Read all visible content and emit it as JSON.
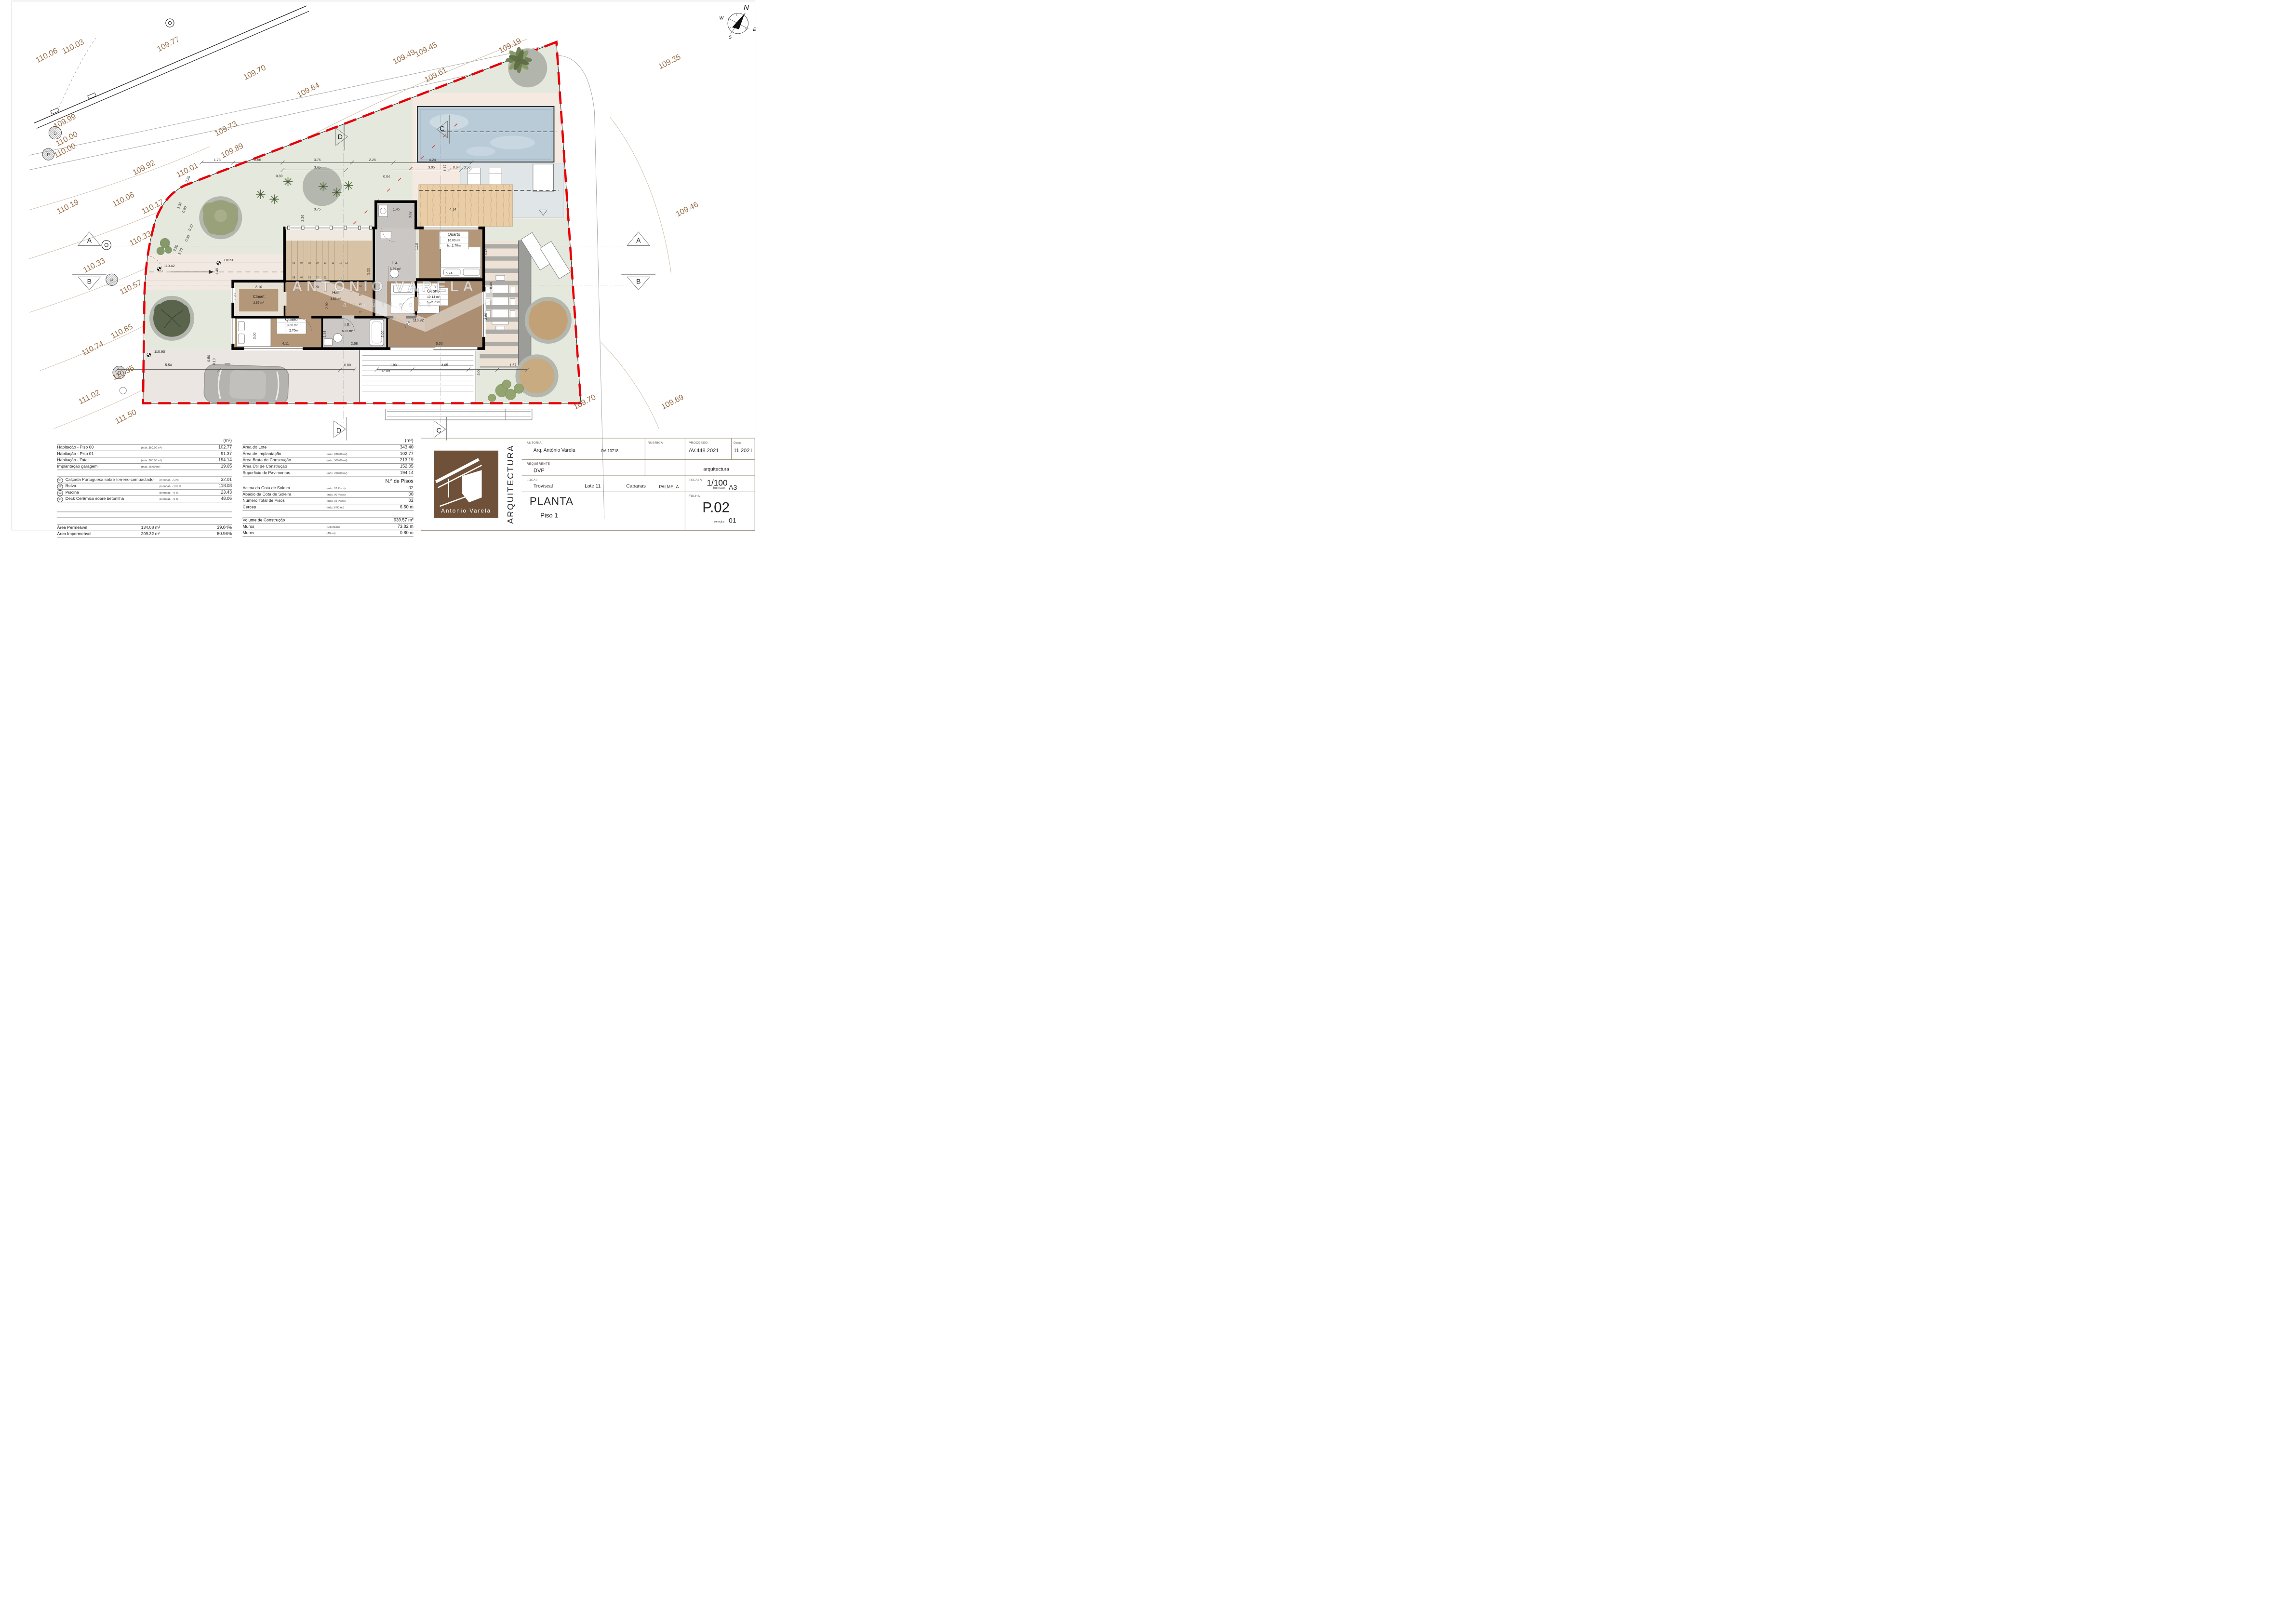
{
  "colors": {
    "boundary_red": "#e60008",
    "contour_text": "#8f6137",
    "logo_brown": "#6e5138",
    "lawn_green": "#e4e8dd",
    "pool_blue": "#b9cbd7",
    "floor_brown": "#b49778",
    "wall_black": "#000000"
  },
  "titleblock": {
    "autoria_label": "AUTORIA",
    "autoria": "Arq. António Varela",
    "oa": "OA.13718",
    "rubrica_label": "RUBRICA",
    "processo_label": "PROCESSO",
    "processo": "AV.448.2021",
    "data_label": "Data",
    "data": "11.2021",
    "requerente_label": "REQUERENTE",
    "requerente": "DVP",
    "discipline": "arquitectura",
    "local_label": "LOCAL",
    "local1": "Troviscal",
    "local2": "Lote 11",
    "local3": "Cabanas",
    "local4": "PALMELA",
    "escala_label": "ESCALA",
    "escala": "1/100",
    "formato_label": "formato",
    "formato": "A3",
    "folha_label": "FOLHA",
    "folha": "P.02",
    "versao_label": "versão",
    "versao": "01",
    "vertical": "ARQUITECTURA",
    "title": "PLANTA",
    "subtitle": "Piso 1",
    "logo_name": "Antonio  Varela"
  },
  "tables": {
    "left": {
      "header_unit": "(m²)",
      "rows": [
        {
          "label": "Habitação - Piso 00",
          "note": "(máx. 280.00 m²)",
          "value": "102.77"
        },
        {
          "label": "Habitação - Piso 01",
          "note": "",
          "value": "91.37"
        },
        {
          "label": "Habitação - Total",
          "note": "(máx. 280.00 m²)",
          "value": "194.14"
        },
        {
          "label": "Implantação garagem",
          "note": "(máx.  25.00 m²)",
          "value": "19.05"
        }
      ],
      "items": [
        {
          "num": "01",
          "label": "Calçada Portuguesa sobre terreno compactado",
          "note": "permeab. -  50%",
          "value": "32.01"
        },
        {
          "num": "02",
          "label": "Relva",
          "note": "permeab. - 100 %",
          "value": "118.08"
        },
        {
          "num": "03",
          "label": "Piscina",
          "note": "permeab. -  0 %",
          "value": "23.43"
        },
        {
          "num": "04",
          "label": "Deck Cerâmico sobre betonilha",
          "note": "permeab. -  0 %",
          "value": "48.06"
        }
      ],
      "totals": [
        {
          "label": "Área Permeável",
          "mid": "134.08 m²",
          "value": "39.04%"
        },
        {
          "label": "Área Impermeável",
          "mid": "209.32 m²",
          "value": "60.96%"
        }
      ]
    },
    "middle": {
      "header_unit": "(m²)",
      "rows": [
        {
          "label": "Área do Lote",
          "note": "",
          "value": "343.40"
        },
        {
          "label": "Área de Implantação",
          "note": "(máx. 280.00 m²)",
          "value": "102.77"
        },
        {
          "label": "Área Bruta de Construção",
          "note": "(máx. 305.00 m²)",
          "value": "213.19"
        },
        {
          "label": "Área Útil de Construção",
          "note": "",
          "value": "152.05"
        },
        {
          "label": "Superficie de Pavimentos",
          "note": "(máx. 280.00 m²)",
          "value": "194.14"
        }
      ],
      "pisos_header": "N.º  de Pisos",
      "pisos": [
        {
          "label": "Acima da Cota de Soleira",
          "note": "(máx. 02 Pisos)",
          "value": "02"
        },
        {
          "label": "Abaixo da Cota de Soleira",
          "note": "(máx. 00 Pisos)",
          "value": "00"
        },
        {
          "label": "Número Total de Pisos",
          "note": "(máx. 02 Pisos)",
          "value": "02"
        },
        {
          "label": "Cércea",
          "note": "(máx.   6.50  m )",
          "value": "6.50 m"
        }
      ],
      "extras": [
        {
          "label": "Volume de Construção",
          "note": "",
          "value": "639.57 m³"
        },
        {
          "label": "Muros",
          "note": "(Extensão)",
          "value": "73.82 m"
        },
        {
          "label": "Muros",
          "note": "(Altura)",
          "value": "0.80 m"
        }
      ]
    }
  },
  "plan": {
    "groups": [
      {
        "name": "contour-elevations",
        "cls": "ct",
        "rot": -27,
        "items": [
          [
            "110.03",
            152,
            100
          ],
          [
            "110.06",
            98,
            118
          ],
          [
            "109.77",
            347,
            95
          ],
          [
            "109.70",
            524,
            153
          ],
          [
            "109.64",
            634,
            189
          ],
          [
            "109.73",
            465,
            268
          ],
          [
            "109.89",
            478,
            313
          ],
          [
            "109.99",
            135,
            253
          ],
          [
            "110.00",
            139,
            289
          ],
          [
            "110.00",
            135,
            313
          ],
          [
            "109.92",
            297,
            348
          ],
          [
            "110.01",
            386,
            353
          ],
          [
            "110.19",
            141,
            428
          ],
          [
            "110.06",
            255,
            413
          ],
          [
            "110.17",
            315,
            428
          ],
          [
            "110.33",
            290,
            493
          ],
          [
            "110.33",
            195,
            548
          ],
          [
            "110.57",
            270,
            593
          ],
          [
            "110.85",
            252,
            683
          ],
          [
            "110.74",
            192,
            718
          ],
          [
            "110.95",
            255,
            768
          ],
          [
            "111.02",
            185,
            818
          ],
          [
            "111.50",
            260,
            858
          ],
          [
            "109.49",
            830,
            121
          ],
          [
            "109.45",
            875,
            106
          ],
          [
            "109.61",
            895,
            158
          ],
          [
            "109.19",
            1047,
            98
          ],
          [
            "109.35",
            1374,
            131
          ],
          [
            "109.46",
            1410,
            433
          ],
          [
            "109.70",
            1200,
            828
          ],
          [
            "109.69",
            1380,
            828
          ]
        ]
      },
      {
        "name": "dimensions",
        "cls": "dim",
        "items": [
          [
            "1.73",
            445,
            330
          ],
          [
            "2.66",
            528,
            330
          ],
          [
            "3.75",
            650,
            330
          ],
          [
            "2.25",
            763,
            330
          ],
          [
            "4.24",
            886,
            330
          ],
          [
            "3.45",
            650,
            345
          ],
          [
            "3.05",
            884,
            345
          ],
          [
            "0.64",
            935,
            345
          ],
          [
            "0.50",
            957,
            345
          ],
          [
            "0.30",
            572,
            363
          ],
          [
            "0.04",
            792,
            364
          ],
          [
            "3.75",
            650,
            431
          ],
          [
            "1.45",
            812,
            431
          ],
          [
            "4.14",
            928,
            431
          ],
          [
            "3.62",
            843,
            440,
            -90
          ],
          [
            "2.20",
            622,
            447,
            -90
          ],
          [
            "2.22",
            757,
            556,
            -90
          ],
          [
            "1.10",
            856,
            505,
            -90
          ],
          [
            "5.74",
            920,
            562
          ],
          [
            "2.10",
            530,
            590
          ],
          [
            "1.20",
            646,
            590
          ],
          [
            "1.70",
            484,
            608,
            -90
          ],
          [
            "2.92",
            672,
            626,
            -90
          ],
          [
            "3.00",
            524,
            688,
            -90
          ],
          [
            "1.91",
            667,
            684,
            -90
          ],
          [
            "2.06",
            786,
            684,
            -90
          ],
          [
            "4.11",
            585,
            706
          ],
          [
            "2.68",
            726,
            706
          ],
          [
            "5.00",
            900,
            706
          ],
          [
            "5.54",
            345,
            750
          ],
          [
            "0.80",
            712,
            750
          ],
          [
            "1.93",
            806,
            750
          ],
          [
            "3.05",
            911,
            750
          ],
          [
            "1.57",
            1051,
            750
          ],
          [
            "12.89",
            790,
            762
          ],
          [
            "1.17",
            914,
            344,
            -90
          ],
          [
            "3.45",
            998,
            516,
            -90
          ],
          [
            "8.00",
            1008,
            585,
            -90
          ],
          [
            "3.60",
            998,
            648,
            -90
          ],
          [
            "3.00",
            983,
            762,
            -90
          ],
          [
            "0.35",
            387,
            368,
            -65
          ],
          [
            "1.37",
            370,
            422,
            -65
          ],
          [
            "0.80",
            380,
            430,
            -65
          ],
          [
            "0.22",
            393,
            467,
            -65
          ],
          [
            "0.30",
            386,
            489,
            -65
          ],
          [
            "2.80",
            362,
            509,
            -65
          ],
          [
            "2.20",
            372,
            516,
            -65
          ],
          [
            "0.50",
            430,
            734,
            -90
          ],
          [
            "0.10",
            441,
            741,
            -90
          ],
          [
            "1.40",
            447,
            556,
            -90
          ]
        ]
      },
      {
        "name": "room-names",
        "cls": "rm",
        "items": [
          [
            "I.S.",
            810,
            540
          ],
          [
            "Quarto",
            930,
            483
          ],
          [
            "Quarto",
            888,
            599
          ],
          [
            "Quarto",
            597,
            657
          ],
          [
            "Closet",
            530,
            610
          ],
          [
            "Hall",
            688,
            602
          ],
          [
            "I.S.",
            712,
            668
          ]
        ]
      },
      {
        "name": "room-areas",
        "cls": "ra",
        "items": [
          [
            "5.56 m²",
            810,
            553
          ],
          [
            "16.00 m²",
            930,
            494
          ],
          [
            "h.=2.70m",
            930,
            505
          ],
          [
            "19.14 m²",
            888,
            610
          ],
          [
            "h.=2.70m",
            888,
            621
          ],
          [
            "13.00 m²",
            597,
            668
          ],
          [
            "h.=2.70m",
            597,
            679
          ],
          [
            "3.57 m²",
            530,
            622
          ],
          [
            "3.53 m²",
            688,
            614
          ],
          [
            "5.15 m²",
            712,
            680
          ]
        ]
      },
      {
        "name": "spot-levels",
        "cls": "lv",
        "anchor": "start",
        "items": [
          [
            "110.42",
            336,
            547
          ],
          [
            "110.90",
            458,
            535
          ],
          [
            "110.90",
            316,
            723
          ],
          [
            "113.92",
            846,
            658
          ]
        ]
      },
      {
        "name": "section-markers",
        "cls": "mk",
        "items": [
          [
            "A",
            183,
            497
          ],
          [
            "A",
            1308,
            497
          ],
          [
            "B",
            183,
            581
          ],
          [
            "B",
            1308,
            581
          ],
          [
            "D",
            697,
            285
          ],
          [
            "C",
            906,
            268
          ],
          [
            "D",
            694,
            886
          ],
          [
            "C",
            899,
            886
          ]
        ]
      },
      {
        "name": "utility-symbols",
        "cls": "us",
        "items": [
          [
            "D",
            113,
            276
          ],
          [
            "P",
            99,
            320
          ],
          [
            "P",
            229,
            577
          ],
          [
            "D",
            244,
            767
          ]
        ]
      },
      {
        "name": "stair-numbers",
        "cls": "st",
        "items": [
          [
            "06",
            602,
            540
          ],
          [
            "07",
            618,
            540
          ],
          [
            "08",
            634,
            540
          ],
          [
            "09",
            650,
            540
          ],
          [
            "10",
            666,
            540
          ],
          [
            "11",
            682,
            540
          ],
          [
            "12",
            698,
            540
          ],
          [
            "13",
            710,
            540
          ],
          [
            "05",
            602,
            570
          ],
          [
            "04",
            618,
            570
          ],
          [
            "03",
            634,
            570
          ],
          [
            "02",
            650,
            570
          ],
          [
            "01",
            666,
            570
          ],
          [
            "14",
            738,
            588
          ],
          [
            "15",
            738,
            606
          ],
          [
            "16",
            738,
            624
          ],
          [
            "17",
            738,
            642
          ]
        ]
      },
      {
        "name": "watermark-name",
        "cls": "w1",
        "items": [
          [
            "ANTÓNIO VARELA",
            788,
            597
          ]
        ]
      },
      {
        "name": "watermark-sub",
        "cls": "w2",
        "items": [
          [
            "a r q u i t e c t o",
            795,
            628
          ]
        ]
      },
      {
        "name": "compass-north",
        "cls": "cn",
        "items": [
          [
            "N",
            1529,
            20
          ]
        ]
      },
      {
        "name": "compass-dirs",
        "cls": "cs",
        "items": [
          [
            "W",
            1478,
            40
          ],
          [
            "E",
            1546,
            63
          ],
          [
            "S",
            1496,
            79
          ]
        ]
      }
    ]
  }
}
